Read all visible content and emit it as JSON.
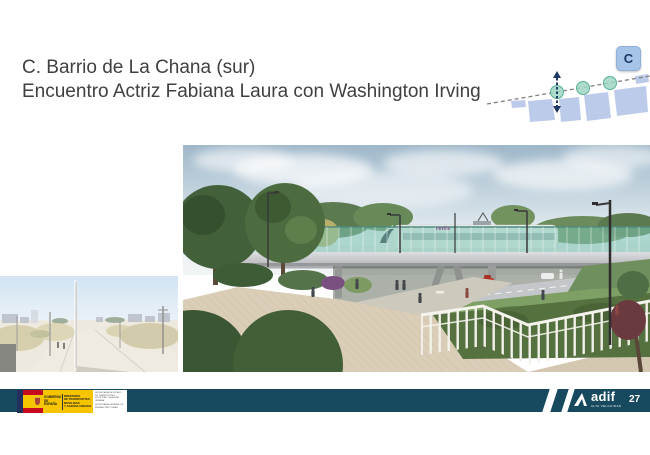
{
  "slide": {
    "title_line1": "C. Barrio de La Chana (sur)",
    "title_line2": "Encuentro Actriz Fabiana Laura con Washington Irving",
    "page_number": "27"
  },
  "location_map": {
    "badge_label": "C"
  },
  "main_render": {
    "train_label": "renfe"
  },
  "footer": {
    "gobierno_line1": "GOBIERNO",
    "gobierno_line2": "DE ESPAÑA",
    "ministerio_line1": "MINISTERIO",
    "ministerio_line2": "DE TRANSPORTES, MOVILIDAD",
    "ministerio_line3": "Y AGENDA URBANA",
    "secretaria_block1": "SECRETARÍA DE ESTADO DE TRANSPORTES, MOVILIDAD Y AGENDA URBANA",
    "secretaria_block2": "SECRETARÍA GENERAL DE INFRAESTRUCTURAS",
    "adif_label": "adif",
    "adif_sublabel": "ALTA VELOCIDAD"
  },
  "colors": {
    "footer_teal": "#174a5e",
    "badge_blue": "#a6c4e7",
    "map_block_blue": "#bdcbea",
    "map_circle_green": "#9fd6c3",
    "arrow_navy": "#1f3864",
    "title_gray": "#404040",
    "renfe_purple": "#8b4a8f",
    "flag_red": "#c60b1e",
    "flag_yellow": "#f7c500"
  }
}
